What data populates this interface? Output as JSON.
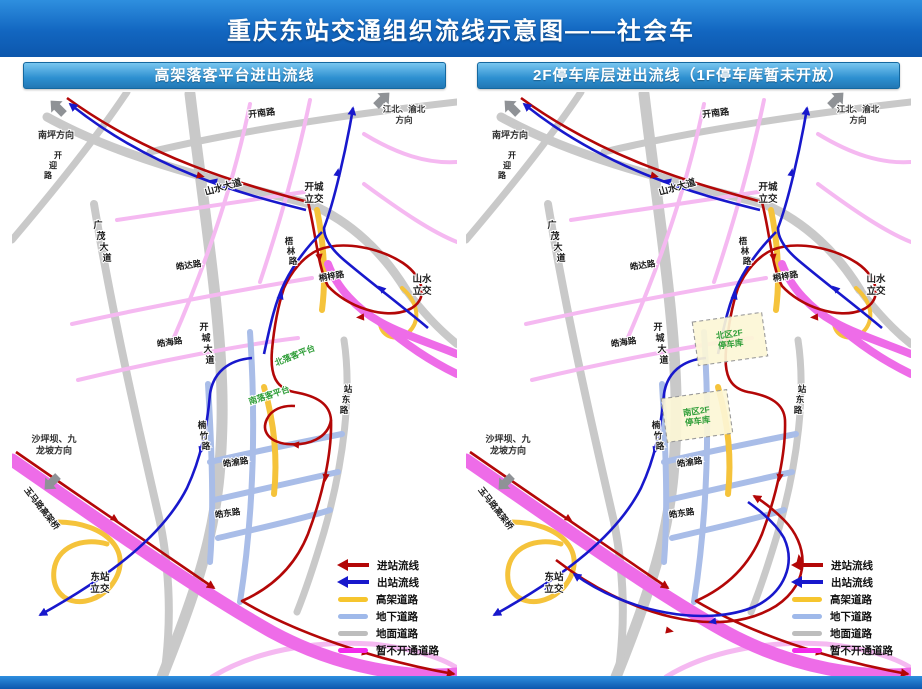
{
  "title": "重庆东站交通组织流线示意图——社会车",
  "colors": {
    "flow_in": "#b30707",
    "flow_out": "#1818cc",
    "elevated": "#f5c33b",
    "underground": "#a9bde8",
    "surface": "#c9c9c9",
    "closed": "#ee6ce8",
    "closed_light": "#f5b9f1",
    "green_label": "#2f9e38",
    "title_blue": "#1266c0",
    "header_blue": "#2d8fd0"
  },
  "legend": {
    "items": [
      {
        "label": "进站流线",
        "type": "arrow",
        "color": "#b30707"
      },
      {
        "label": "出站流线",
        "type": "arrow",
        "color": "#1818cc"
      },
      {
        "label": "高架道路",
        "type": "bar",
        "color": "#f6c52e"
      },
      {
        "label": "地下道路",
        "type": "bar",
        "color": "#9fb9ea"
      },
      {
        "label": "地面道路",
        "type": "bar",
        "color": "#bdbdbd"
      },
      {
        "label": "暂不开通道路",
        "type": "bar",
        "color": "#f32bea"
      }
    ]
  },
  "direction_arrows": [
    {
      "x": 52,
      "y": 22,
      "rot": -135
    },
    {
      "x": 364,
      "y": 14,
      "rot": -45
    },
    {
      "x": 46,
      "y": 384,
      "rot": 135
    }
  ],
  "map_labels_common": [
    {
      "t": "开南路",
      "x": 250,
      "y": 24,
      "r": -7,
      "fs": 9
    },
    {
      "t": "山水大道",
      "x": 212,
      "y": 98,
      "r": -16,
      "fs": 9.5
    },
    {
      "t": "开迎路",
      "mode": "v",
      "x": 46,
      "y": 66,
      "sx": -5,
      "sy": 10,
      "fs": 8
    },
    {
      "t": "南坪方向",
      "x": 44,
      "y": 46,
      "fs": 9,
      "c": "#2e2e2e"
    },
    {
      "mode": "lines",
      "lines": [
        "江北、渝北",
        "方向"
      ],
      "x": 392,
      "y": 20,
      "fs": 8.5,
      "c": "#2e2e2e"
    },
    {
      "mode": "lines",
      "lines": [
        "开城",
        "立交"
      ],
      "x": 302,
      "y": 98,
      "fs": 9.5
    },
    {
      "mode": "lines",
      "lines": [
        "山水",
        "立交"
      ],
      "x": 410,
      "y": 190,
      "fs": 9.5
    },
    {
      "t": "梧林路",
      "mode": "v",
      "x": 277,
      "y": 152,
      "sx": 2,
      "sy": 10,
      "fs": 8.5
    },
    {
      "t": "桐梓路",
      "x": 320,
      "y": 187,
      "r": -10,
      "fs": 8.5
    },
    {
      "t": "广茂大道",
      "mode": "v",
      "x": 86,
      "y": 136,
      "sx": 3,
      "sy": 11,
      "fs": 9
    },
    {
      "t": "皓达路",
      "x": 177,
      "y": 176,
      "r": -8,
      "fs": 8.5
    },
    {
      "t": "皓海路",
      "x": 158,
      "y": 253,
      "r": -8,
      "fs": 8.5
    },
    {
      "t": "开城大道",
      "mode": "v",
      "x": 192,
      "y": 238,
      "sx": 2,
      "sy": 11,
      "fs": 9
    },
    {
      "t": "楠竹路",
      "mode": "v",
      "x": 190,
      "y": 336,
      "sx": 2,
      "sy": 10.5,
      "fs": 8.5
    },
    {
      "t": "皓渝路",
      "x": 224,
      "y": 373,
      "r": -8,
      "fs": 8.5
    },
    {
      "t": "皓东路",
      "x": 216,
      "y": 424,
      "r": -8,
      "fs": 8.5
    },
    {
      "t": "站东路",
      "mode": "v",
      "x": 336,
      "y": 300,
      "sx": -2,
      "sy": 10.5,
      "fs": 8.5
    },
    {
      "mode": "lines",
      "lines": [
        "东站",
        "立交"
      ],
      "x": 88,
      "y": 488,
      "fs": 9.5
    },
    {
      "t": "玉马路高架桥",
      "x": 12,
      "y": 398,
      "r": 52,
      "fs": 8.5,
      "anchor": "s"
    },
    {
      "mode": "lines",
      "lines": [
        "沙坪坝、九",
        "龙坡方向"
      ],
      "x": 42,
      "y": 350,
      "fs": 9,
      "c": "#2e2e2e"
    }
  ],
  "panels": [
    {
      "id": "left",
      "header": "高架落客平台进出流线",
      "extra_labels": [
        {
          "t": "北落客平台",
          "x": 284,
          "y": 266,
          "r": -22,
          "fs": 8.5,
          "c": "#2f9e38"
        },
        {
          "t": "南落客平台",
          "x": 258,
          "y": 306,
          "r": -18,
          "fs": 8.5,
          "c": "#2f9e38"
        }
      ],
      "parking_boxes": []
    },
    {
      "id": "right",
      "header": "2F停车库层进出流线（1F停车库暂未开放）",
      "extra_labels": [],
      "parking_boxes": [
        {
          "lines": [
            "北区2F",
            "停车库"
          ],
          "x": 229,
          "y": 225,
          "w": 70,
          "h": 44,
          "r": -8
        },
        {
          "lines": [
            "南区2F",
            "停车库"
          ],
          "x": 198,
          "y": 302,
          "w": 66,
          "h": 44,
          "r": -8
        }
      ]
    }
  ]
}
